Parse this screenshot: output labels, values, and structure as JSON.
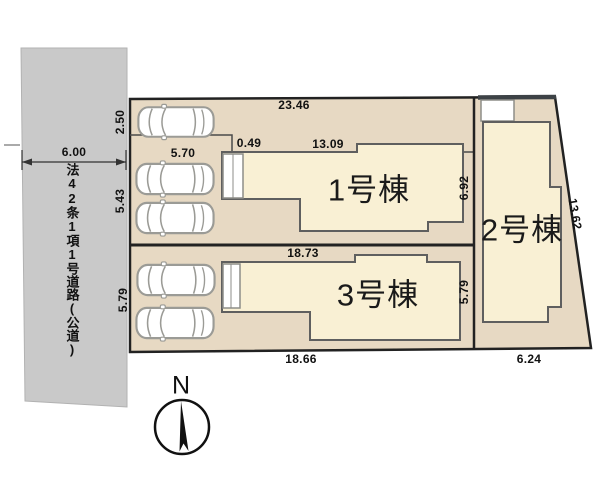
{
  "site_plan": {
    "buildings": [
      {
        "label": "1号棟"
      },
      {
        "label": "2号棟"
      },
      {
        "label": "3号棟"
      }
    ],
    "road_label": "法42条1項1号道路(公道)",
    "compass": {
      "north_label": "N"
    },
    "dimensions": {
      "top_width": "23.46",
      "top_strip_depth": "2.50",
      "road_width": "6.00",
      "frontage_left": "5.70",
      "frontage_step": "0.49",
      "frontage_right": "13.09",
      "left_depth_lot1": "5.43",
      "left_depth_lot3": "5.79",
      "right_depth_lot1": "6.92",
      "right_depth_lot3": "5.79",
      "middle_width": "18.73",
      "bottom_width_left": "18.66",
      "bottom_width_right": "6.24",
      "east_boundary": "13.62"
    },
    "colors": {
      "road": "#c9c9c9",
      "lot_ground": "#e7d9c3",
      "building_fill": "#f9f0d4",
      "outline": "#2a2a2a"
    }
  }
}
